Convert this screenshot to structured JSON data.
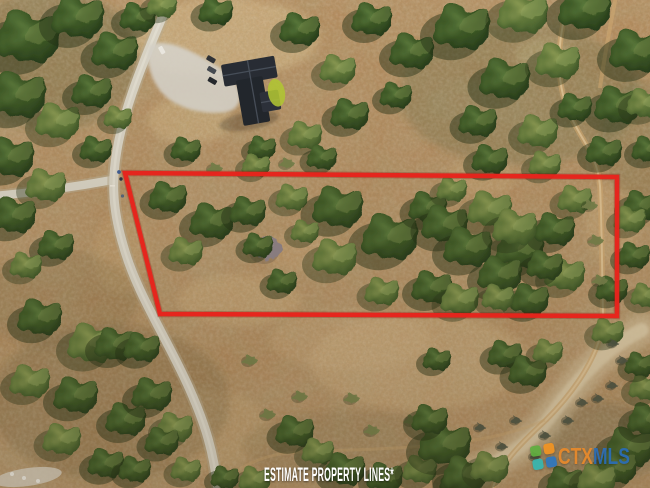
{
  "photo": {
    "description": "Aerial drone photo of a wooded rural land parcel beside a curving road, with a house and driveway at top and an estimated property boundary drawn in red"
  },
  "property_outline": {
    "points": "125,173 617,177 617,316 160,314",
    "color": "#e8231c",
    "under_color": "#7c0e08"
  },
  "overlay": {
    "disclaimer": "ESTIMATE PROPERTY LINES*",
    "brand": {
      "prefix": "CTX",
      "suffix": "MLS",
      "prefix_color": "#e8892b",
      "suffix_color": "#2a6db8",
      "icon_colors": {
        "top_left": "#5fae3f",
        "top_right": "#f29422",
        "bottom_right": "#2e77c0",
        "bottom_left": "#35b6b0"
      }
    }
  }
}
